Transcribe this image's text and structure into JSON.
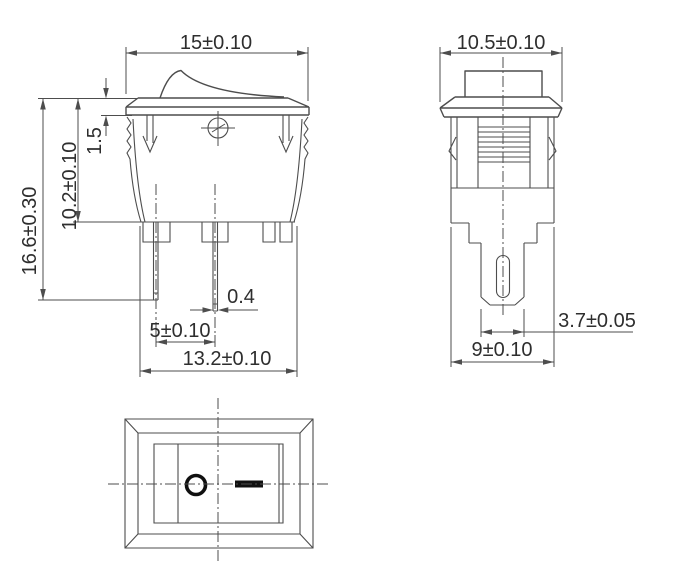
{
  "front_view": {
    "dims": {
      "overall_width": "15±0.10",
      "flange_thickness": "1.5",
      "panel_to_body_bottom": "10.2±0.10",
      "overall_height": "16.6±0.30",
      "terminal_thickness": "0.4",
      "terminal_pitch": "5±0.10",
      "body_width": "13.2±0.10"
    }
  },
  "side_view": {
    "dims": {
      "overall_depth": "10.5±0.10",
      "terminal_width": "3.7±0.05",
      "body_depth": "9±0.10"
    }
  },
  "bottom_view": {
    "off_marking": "O",
    "on_marking": "—"
  },
  "colors": {
    "line": "#4d4d4d",
    "text": "#2e2e2e",
    "symbol": "#101010",
    "background": "#ffffff"
  }
}
